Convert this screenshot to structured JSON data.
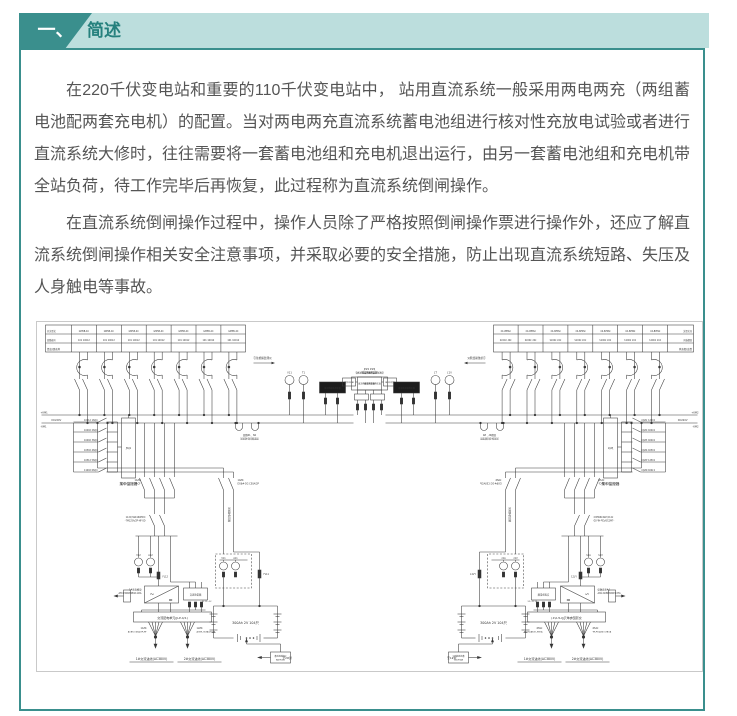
{
  "header": {
    "number": "一、",
    "title": "简述",
    "accent_color": "#3a8f8d",
    "light_color": "#bcdedd"
  },
  "article": {
    "paragraphs": [
      "在220千伏变电站和重要的110千伏变电站中， 站用直流系统一般采用两电两充（两组蓄电池配两套充电机）的配置。当对两电两充直流系统蓄电池组进行核对性充放电试验或者进行直流系统大修时，往往需要将一套蓄电池组和充电机退出运行，由另一套蓄电池组和充电机带全站负荷，待工作完毕后再恢复，此过程称为直流系统倒闸操作。",
      "在直流系统倒闸操作过程中，操作人员除了严格按照倒闸操作票进行操作外，还应了解直流系统倒闸操作相关安全注意事项，并采取必要的安全措施，防止出现直流系统短路、失压及人身触电等事故。"
    ]
  },
  "diagram": {
    "table": {
      "rows": [
        "开关型式",
        "回路编号",
        "馈出回路名称"
      ],
      "cell_type": "GM5B-4C",
      "cell_no": "101 10012"
    },
    "arrow_note": "引往绝缘监测仪",
    "meter_v": "V11",
    "meter_t": "T1",
    "mid_box1": "直流绝缘监测装置",
    "mid_box2_tag": "JP#2",
    "mid_box2": "微机绝缘监测报警装置",
    "mid_box3": "带中央信号",
    "bus": {
      "pos": "+KM1",
      "volt": "DC220V",
      "neg": "-KM1",
      "pos_r": "+KM2",
      "volt_r": "DC220V",
      "neg_r": "-KM2"
    },
    "hook_note1": "回路N1、N2",
    "hook_note2": "试验放电回路连接",
    "monitor_rows": [
      "10012 1SQ4",
      "10402 2SQ4",
      "10492 3SQ4",
      "10502 4SQ4",
      "10512 5SQ4",
      "11002 6SQ4"
    ],
    "monitor_box": "JWJ1",
    "monitor_caption": "集中监控器",
    "bk1_id": "11ZK",
    "bk1_spec": "QS9-125A/2P-CF",
    "bk2_id": "112Q SSK160HDC",
    "bk2_spec": "-7M125A/2P-HF-SD",
    "bk3_id": "14ZK",
    "bk3_spec": "DS6#-DC-C50A/2P",
    "test_label": "试验放电回路",
    "v_meter": "V12",
    "a_meter": "A12",
    "v_meter2": "V11",
    "a_meter2": "A11",
    "fuse1": "FL12",
    "fuse2": "FL11",
    "charger_name": "1#充电模块",
    "charger_model": "ATC230KM2B111#A",
    "surge_box": "交流防雷箱",
    "acdu": "交流配电单元(JLP-4/1)",
    "fan1_id": "11ZK",
    "fan1_spec": "ACB9-C63A/2P-HF",
    "fan2_id": "12ZK",
    "fan2_spec": "ACB9-C63A/2P-HF",
    "ac_in1": "1#交流进线(AC380V)",
    "ac_in2": "2#交流进线(AC380V)",
    "battery_spec": "300Ah 2V 104只",
    "battery_fuse_note": "FL11~12",
    "patrol_box1": "蓄电池巡检仪",
    "patrol_box2": "BAT9000",
    "patrol_arrow": "至1#屏",
    "patrol_arrow_r": "至2#屏"
  }
}
